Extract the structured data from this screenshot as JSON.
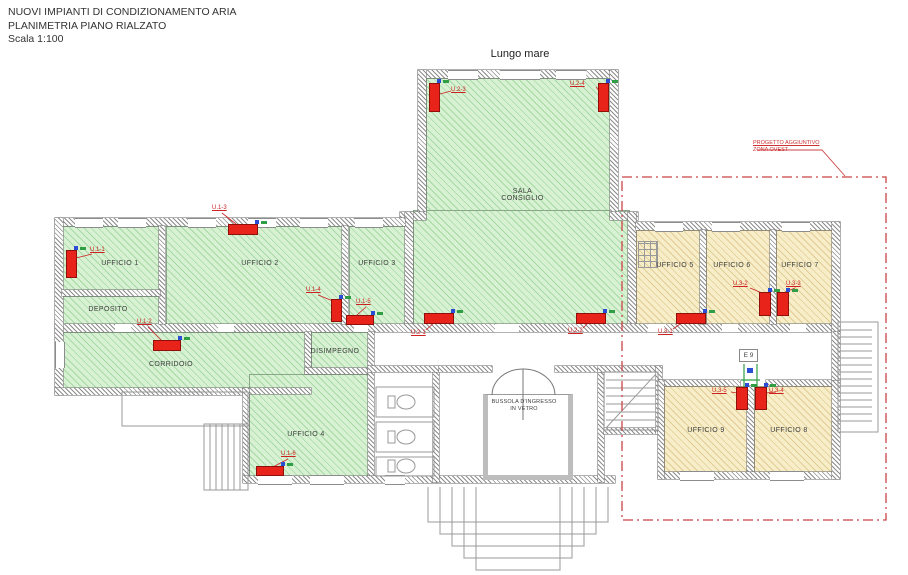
{
  "title_block": {
    "line1": "NUOVI IMPIANTI DI CONDIZIONAMENTO ARIA",
    "line2": "PLANIMETRIA PIANO RIALZATO",
    "line3": "Scala 1:100"
  },
  "annotations": {
    "top_label": "Lungo mare",
    "zone_note_line1": "PROGETTO AGGIUNTIVO",
    "zone_note_line2": "ZONA OVEST",
    "door_tag": "E 9"
  },
  "rooms": {
    "ufficio1": {
      "label": "UFFICIO 1"
    },
    "ufficio2": {
      "label": "UFFICIO 2"
    },
    "ufficio3": {
      "label": "UFFICIO 3"
    },
    "deposito": {
      "label": "DEPOSITO"
    },
    "corridoio": {
      "label": "CORRIDOIO"
    },
    "disimpegno": {
      "label": "DISIMPEGNO"
    },
    "ufficio4": {
      "label": "UFFICIO 4"
    },
    "sala_consiglio": {
      "label": "SALA\nCONSIGLIO"
    },
    "ufficio5": {
      "label": "UFFICIO 5"
    },
    "ufficio6": {
      "label": "UFFICIO 6"
    },
    "ufficio7": {
      "label": "UFFICIO 7"
    },
    "ufficio9": {
      "label": "UFFICIO 9"
    },
    "ufficio8": {
      "label": "UFFICIO 8"
    },
    "bussola": {
      "label": "BUSSOLA D'INGRESSO\nIN VETRO"
    }
  },
  "units": {
    "u1_1": {
      "label": "U.1-1"
    },
    "u1_2": {
      "label": "U.1-2"
    },
    "u1_3": {
      "label": "U.1-3"
    },
    "u1_4": {
      "label": "U.1-4"
    },
    "u1_5": {
      "label": "U.1-5"
    },
    "u1_6": {
      "label": "U.1-6"
    },
    "u2_1": {
      "label": "U.2-1"
    },
    "u2_2": {
      "label": "U.2-2"
    },
    "u2_3": {
      "label": "U.2-3"
    },
    "u2_4": {
      "label": "U.2-4"
    },
    "u3_1": {
      "label": "U.3-1"
    },
    "u3_2": {
      "label": "U.3-2"
    },
    "u3_3": {
      "label": "U.3-3"
    },
    "u3_4": {
      "label": "U.3-4"
    },
    "u3_5": {
      "label": "U.3-5"
    }
  },
  "colors": {
    "zone_existing_green": "#d9f1d3",
    "zone_new_tan": "#f7eec9",
    "ac_unit_red": "#e8231a",
    "annotation_red": "#cc3333",
    "wall_gray": "#8d8d8d"
  }
}
